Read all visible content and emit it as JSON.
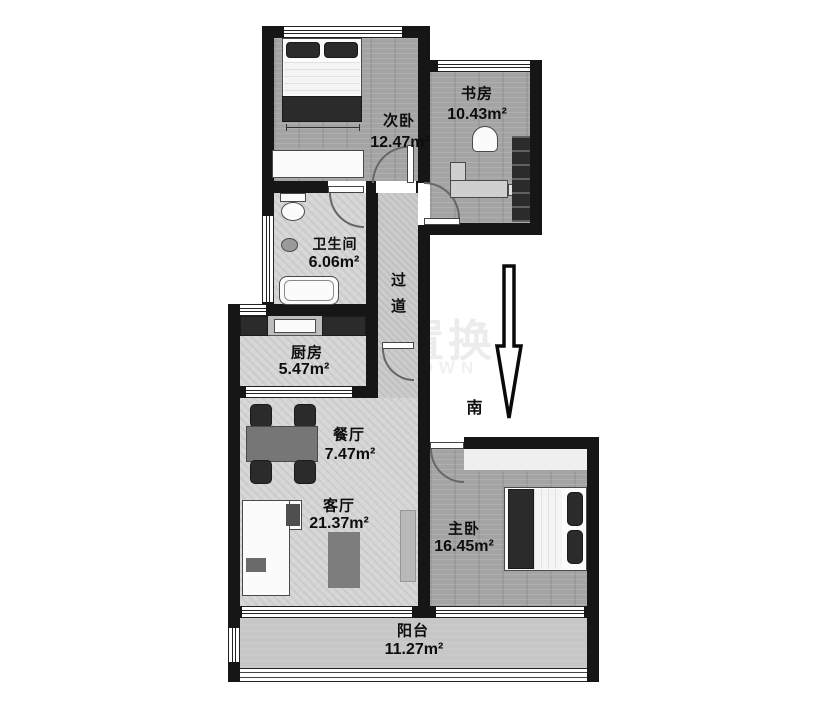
{
  "floorplan": {
    "rooms": {
      "ciwo": {
        "name": "次卧",
        "area": "12.47m²"
      },
      "shufang": {
        "name": "书房",
        "area": "10.43m²"
      },
      "weishengjian": {
        "name": "卫生间",
        "area": "6.06m²"
      },
      "guodao": {
        "name": "过道"
      },
      "chufang": {
        "name": "厨房",
        "area": "5.47m²"
      },
      "canting": {
        "name": "餐厅",
        "area": "7.47m²"
      },
      "keting": {
        "name": "客厅",
        "area": "21.37m²"
      },
      "zhuwo": {
        "name": "主卧",
        "area": "16.45m²"
      },
      "yangtai": {
        "name": "阳台",
        "area": "11.27m²"
      }
    },
    "compass": {
      "label": "南"
    },
    "watermark": {
      "text": "城置换",
      "subtext": "ENTOWN"
    },
    "colors": {
      "wall": "#161616",
      "floor_wood": "#a4a4a4",
      "floor_tile": "#d6d6d6",
      "furniture_dark": "#2b2b2b"
    }
  }
}
